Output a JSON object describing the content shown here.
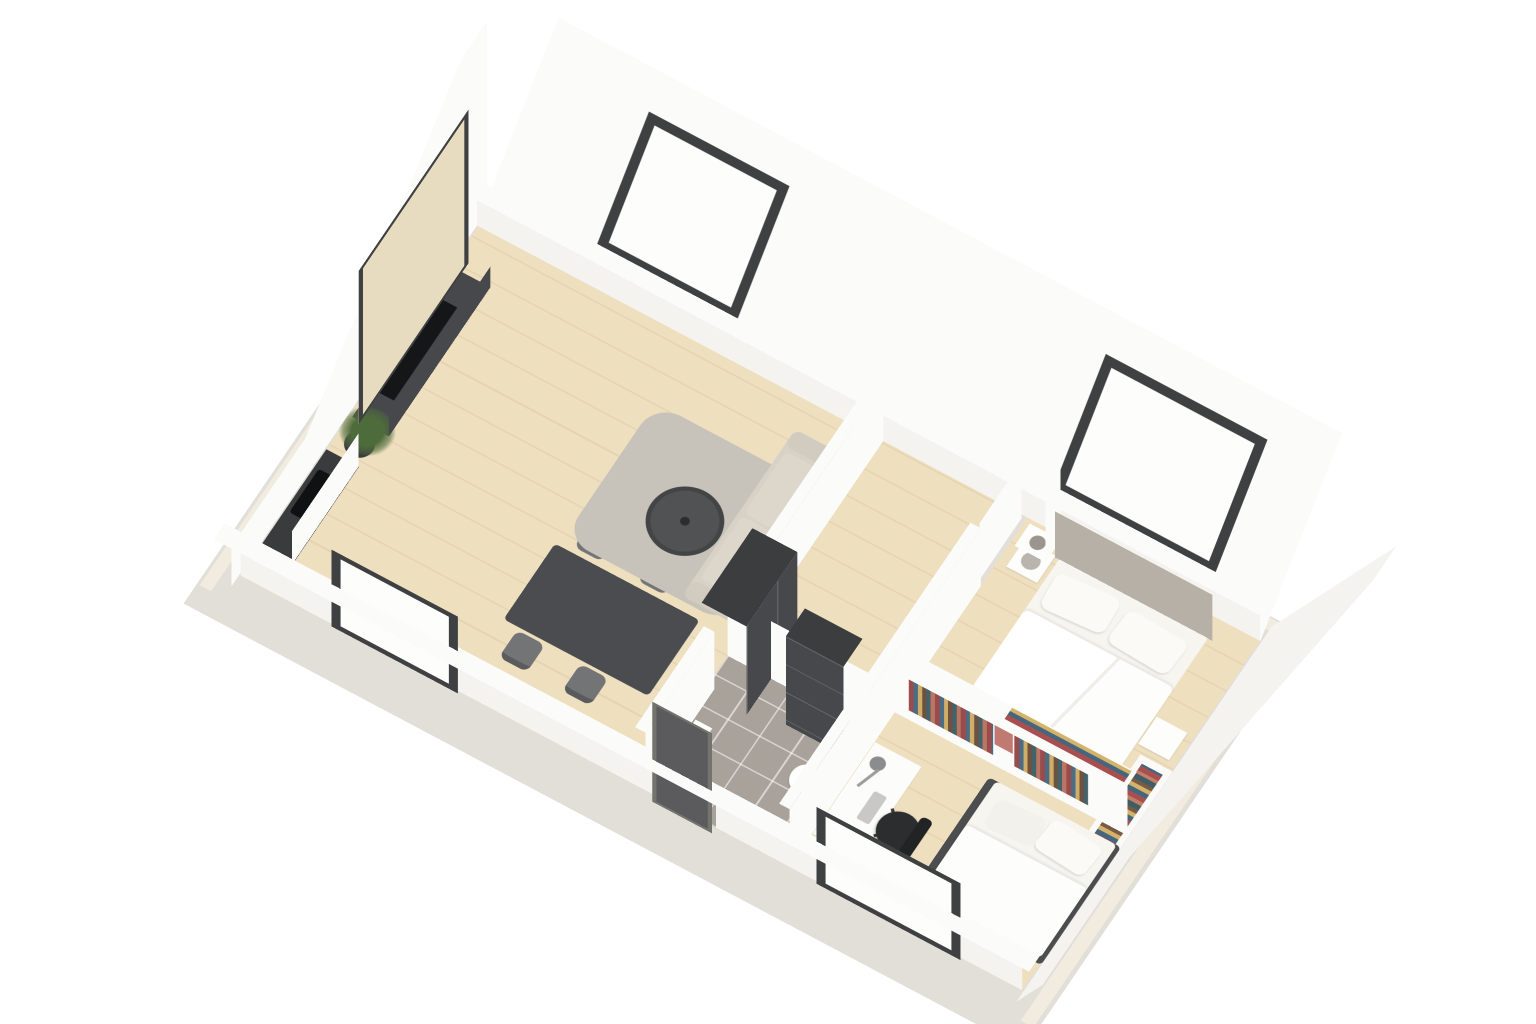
{
  "scene": {
    "type": "3d-floor-plan-render",
    "view": "isometric cutaway dollhouse view, plan rotated ~31 degrees",
    "setting": "small attic apartment with sloped roof and two skylights",
    "background": "#ffffff",
    "text_visible": "none"
  },
  "palette": {
    "bg": "#ffffff",
    "slab": "#e2dfd9",
    "cream": "#f1ecdf",
    "wallWhite": "#fbfbf9",
    "wallShade": "#f4f3ef",
    "wood": "#eedfbf",
    "tile": "#a8a29a",
    "rug": "#c8c3ba",
    "counter": "#3a3b3d",
    "frameDark": "#3f4042",
    "door": "#5b5b5d",
    "ward": "#3c3d3f",
    "wardFace": "#47484b",
    "panelBeige": "#e8dcc0",
    "sofa": "#d7d1c6",
    "bedding": "#f7f5f0",
    "headboard": "#b6b0a6",
    "chairGray": "#737476",
    "tableDark": "#4b4c4f",
    "glass": "#fdfdfc",
    "plantGreen": "#4e6b3c",
    "seatBlack": "#2c2d2f"
  },
  "rooms": [
    {
      "id": "living-dining-kitchen",
      "label": "Living / dining / kitchen",
      "furniture": [
        "framed TV wall panel",
        "TV sideboard with flat TV",
        "potted plant",
        "L-shaped kitchen counter with black cooktop",
        "dark dining table",
        "4 grey dining chairs",
        "grey area rug",
        "round dark coffee table",
        "beige 3-seat sofa"
      ],
      "openings": [
        "roof skylight",
        "dark-framed front window"
      ]
    },
    {
      "id": "hallway",
      "label": "Hallway",
      "furniture": [
        "dark chest of drawers",
        "dark wardrobe"
      ],
      "openings": [
        "dark panelled entrance door",
        "white bedroom door"
      ]
    },
    {
      "id": "bathroom",
      "label": "Bathroom",
      "floor": "grey tiles",
      "furniture": [
        "toilet",
        "washbasin"
      ]
    },
    {
      "id": "bedroom",
      "label": "Bedroom",
      "furniture": [
        "double bed with white duvet and 2 pillows",
        "grey upholstered headboard",
        "2 white nightstands",
        "round table lamp",
        "white shelf column with vases",
        "book ledge filled with colourful books"
      ],
      "openings": [
        "roof skylight"
      ]
    },
    {
      "id": "study",
      "label": "Study / kids room",
      "furniture": [
        "single bed with dark base",
        "white desk",
        "desk lamp",
        "small plant",
        "black office chair",
        "white divider bookshelf with colourful books"
      ],
      "openings": [
        "dark-framed front window"
      ]
    }
  ],
  "counts": {
    "skylights": 2,
    "front_windows": 2,
    "doors": 2,
    "dining_chairs": 4,
    "beds": 2,
    "wardrobes": 2,
    "nightstands": 2,
    "sofas": 1
  }
}
